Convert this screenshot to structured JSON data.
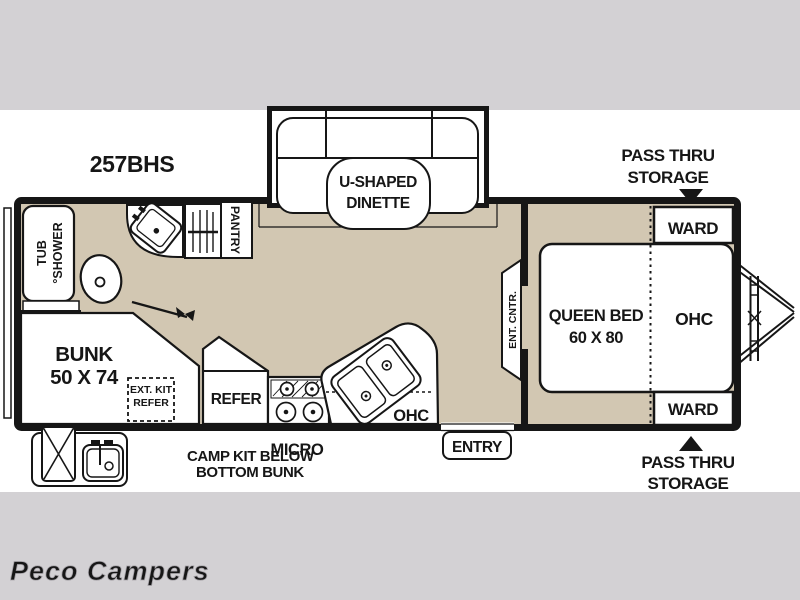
{
  "title": "257BHS",
  "watermark": "Peco Campers",
  "colors": {
    "floor": "#d2c7b2",
    "band": "#d3d1d4",
    "wall": "#161616",
    "fixture_white": "#ffffff",
    "watermark_gray": "#cfcdd1"
  },
  "labels": {
    "dinette": [
      "U-SHAPED",
      "DINETTE"
    ],
    "pass_thru_top": [
      "PASS THRU",
      "STORAGE"
    ],
    "pass_thru_bottom": [
      "PASS THRU",
      "STORAGE"
    ],
    "ward_top": "WARD",
    "ward_bottom": "WARD",
    "queen_bed": [
      "QUEEN BED",
      "60 X 80"
    ],
    "bedroom_ohc": "OHC",
    "ent_cntr": "ENT. CNTR.",
    "tub_shower": [
      "TUB",
      "°SHOWER"
    ],
    "pantry": "PANTRY",
    "bunk": [
      "BUNK",
      "50 X 74"
    ],
    "ext_kit": [
      "EXT. KIT",
      "REFER"
    ],
    "refer": "REFER",
    "micro": "MICRO",
    "kitchen_ohc": "OHC",
    "entry": "ENTRY",
    "camp_kit": [
      "CAMP KIT BELOW",
      "BOTTOM BUNK"
    ]
  }
}
